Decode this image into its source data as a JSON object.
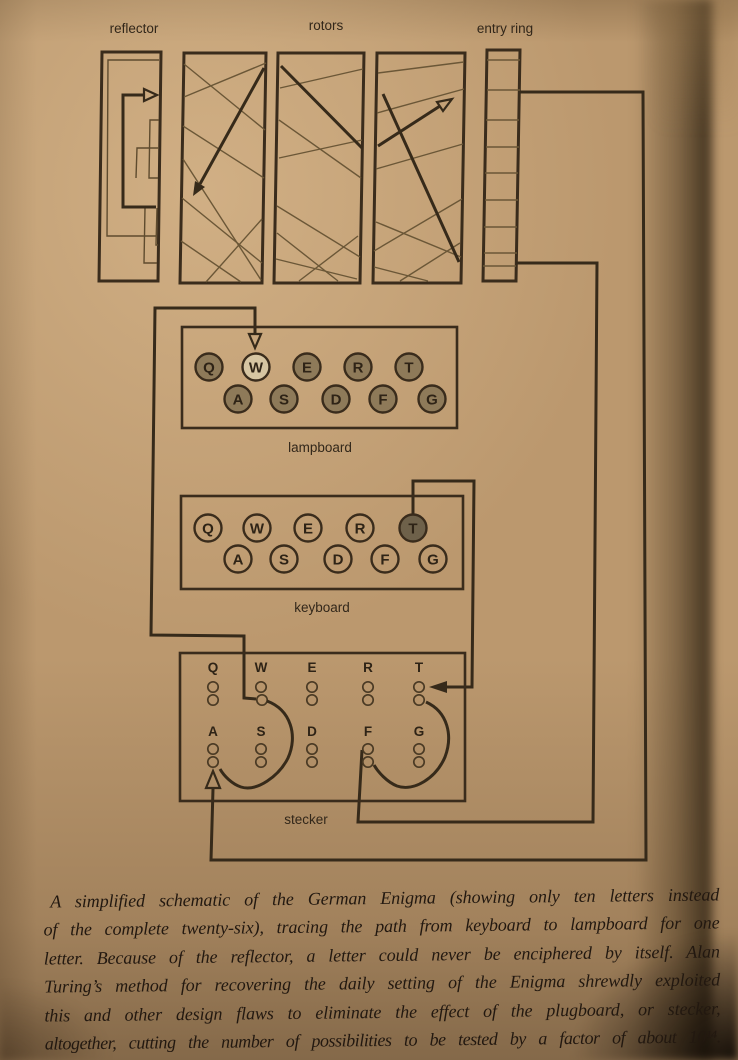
{
  "figure": {
    "labels": {
      "reflector": "reflector",
      "rotors": "rotors",
      "entry_ring": "entry ring",
      "lampboard": "lampboard",
      "keyboard": "keyboard",
      "stecker": "stecker"
    },
    "lampboard": {
      "row1": [
        "Q",
        "W",
        "E",
        "R",
        "T"
      ],
      "row2": [
        "A",
        "S",
        "D",
        "F",
        "G"
      ],
      "lit_letter": "W"
    },
    "keyboard": {
      "row1": [
        "Q",
        "W",
        "E",
        "R",
        "T"
      ],
      "row2": [
        "A",
        "S",
        "D",
        "F",
        "G"
      ],
      "pressed_letter": "T"
    },
    "stecker": {
      "row1": [
        "Q",
        "W",
        "E",
        "R",
        "T"
      ],
      "row2": [
        "A",
        "S",
        "D",
        "F",
        "G"
      ]
    }
  },
  "caption": {
    "lines": [
      "A simplified schematic of the German Enigma (showing only ten letters instead",
      "of the complete twenty-six), tracing the path from keyboard to lampboard for one",
      "letter. Because of the reflector, a letter could never be enciphered by itself. Alan",
      "Turing’s method for recovering the daily setting of the Enigma shrewdly exploited",
      "this and other design flaws to eliminate the effect of the plugboard, or stecker,",
      "altogether, cutting the number of possibilities to be tested by a factor of about 10¹⁴."
    ]
  },
  "colors": {
    "paper": "#bb986e",
    "ink": "#3a2c1c",
    "lamp_shaded": "#8e7a59",
    "lamp_lit": "#d6c5a2",
    "key_pressed": "#6e614a"
  }
}
